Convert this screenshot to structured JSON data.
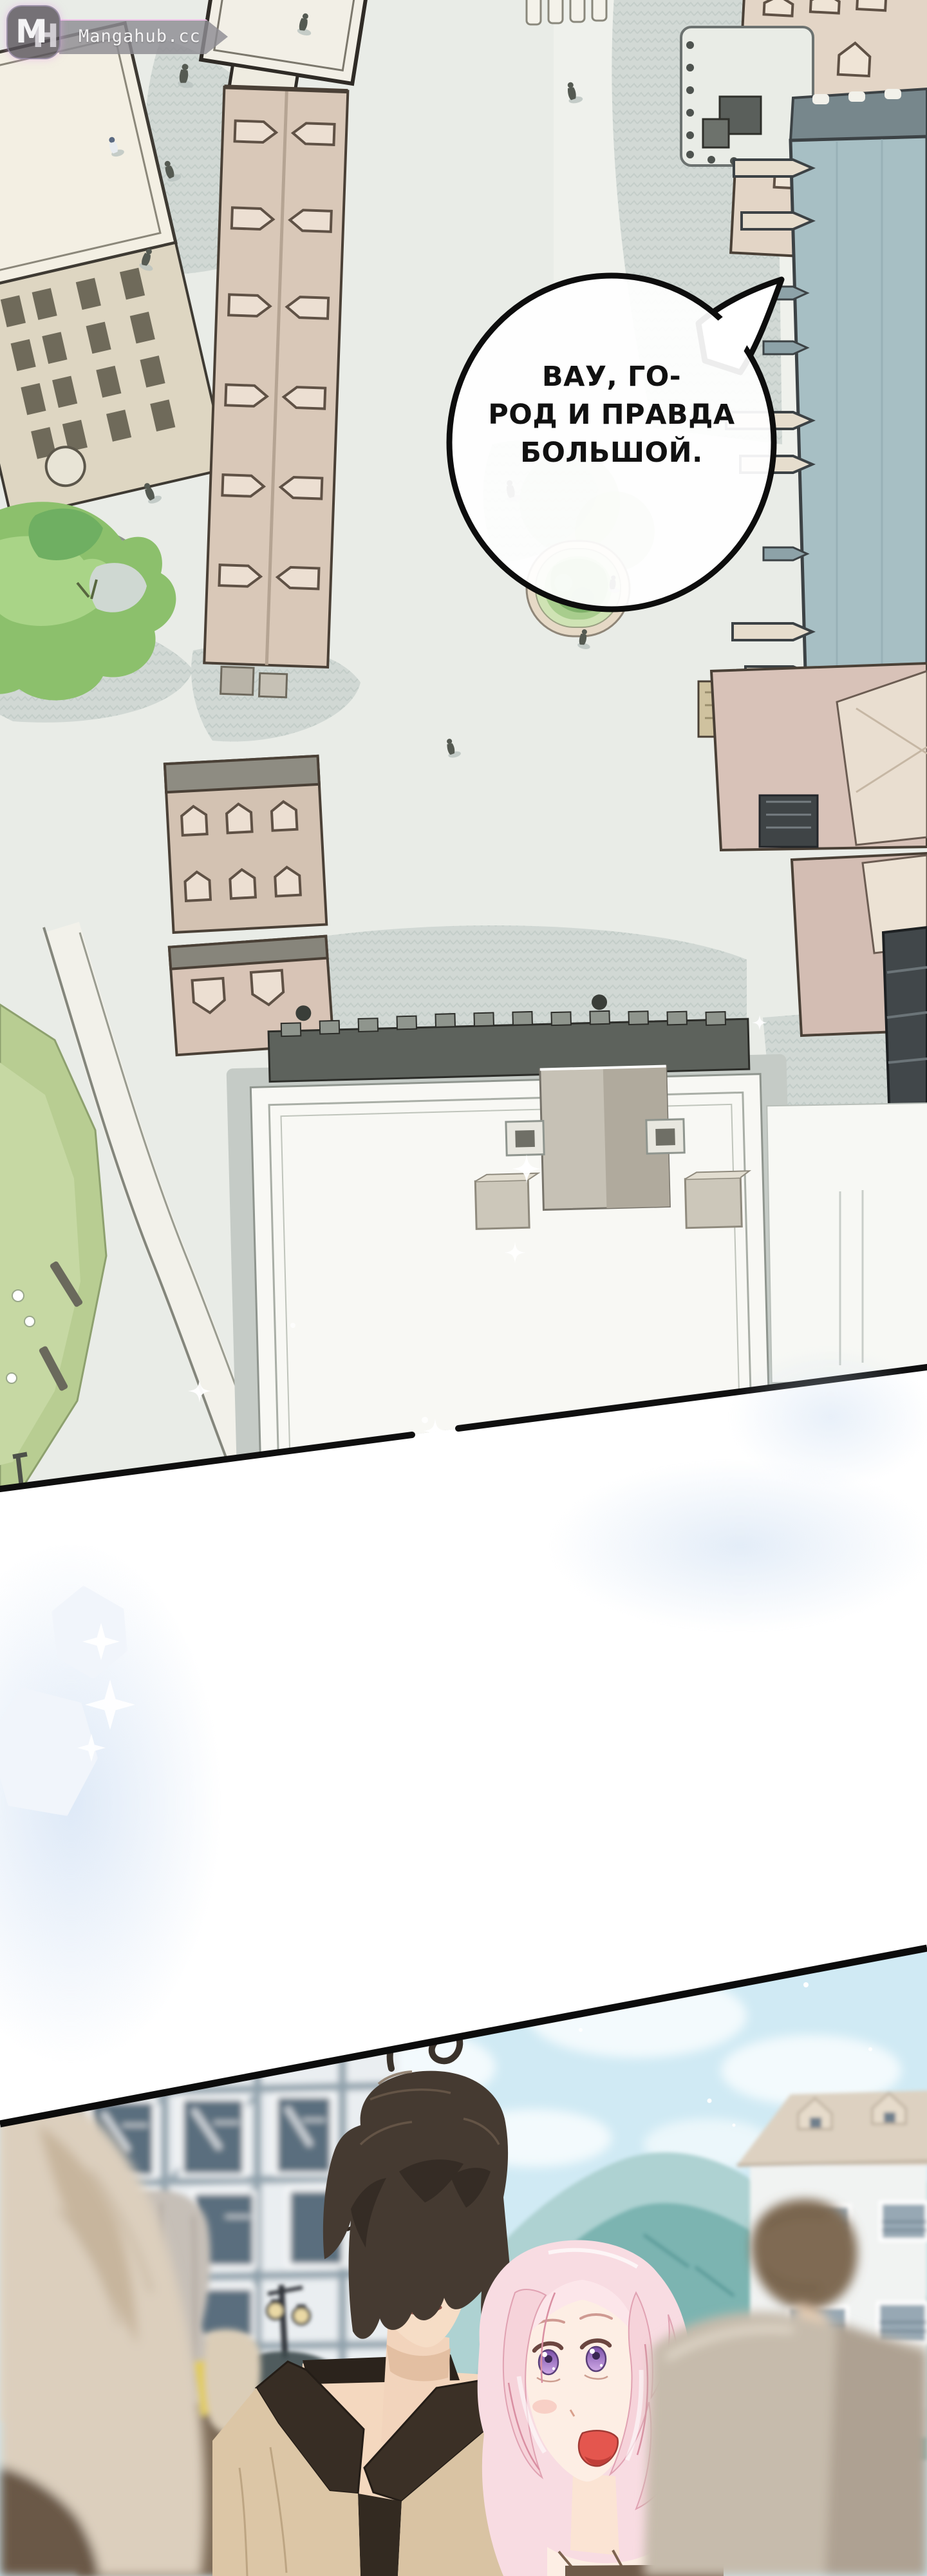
{
  "watermark": {
    "logo_m": "M",
    "logo_h": "H",
    "site": "Mangahub.cc"
  },
  "speech_bubble": {
    "lines": [
      "ВАУ, ГО-",
      "РОД И ПРАВДА",
      "БОЛЬШОЙ."
    ]
  },
  "palette": {
    "paper": "#ffffff",
    "ink": "#0f0f0f",
    "wm_badge": "#585258",
    "wm_banner": "#8e8c92",
    "wm_glow": "#f0aaeb",
    "wm_text": "#f4f3f4",
    "bubble_fill": "#ffffff",
    "bubble_border": "#0d0d0d",
    "bubble_text": "#111111",
    "ground": "#e9ece7",
    "ground_shadow": "#cdd5d1",
    "building_beige": "#d9c8b8",
    "building_cream": "#f3efe3",
    "building_teal": "#a7bfc4",
    "building_pink": "#d8c2b8",
    "park_green": "#b8cd92",
    "tree_green": "#7fb069",
    "crystal": "#f1f5fb",
    "glow_blue": "#cddef2",
    "sky": "#d0eaf4",
    "cloud": "#f3fafd",
    "mountain_far": "#aed2d2",
    "mountain_near": "#7cb4b1",
    "man_hair": "#453a31",
    "man_skin": "#f6ddc6",
    "man_eye": "#4f8fa8",
    "vest_tan": "#dcc6a6",
    "collar_dark": "#362c23",
    "woman_hair": "#f8dce2",
    "woman_hair_line": "#d98fa2",
    "woman_skin": "#fdeee4",
    "woman_eye": "#9a6fc0",
    "mouth_red": "#e4564e",
    "crowd_beige": "#dccfbd",
    "crowd_brown": "#7e6c58",
    "crowd_gray_hair": "#c6bfb7",
    "crowd_yellow": "#e2cb50",
    "lamp_glow": "#ead9a5"
  }
}
